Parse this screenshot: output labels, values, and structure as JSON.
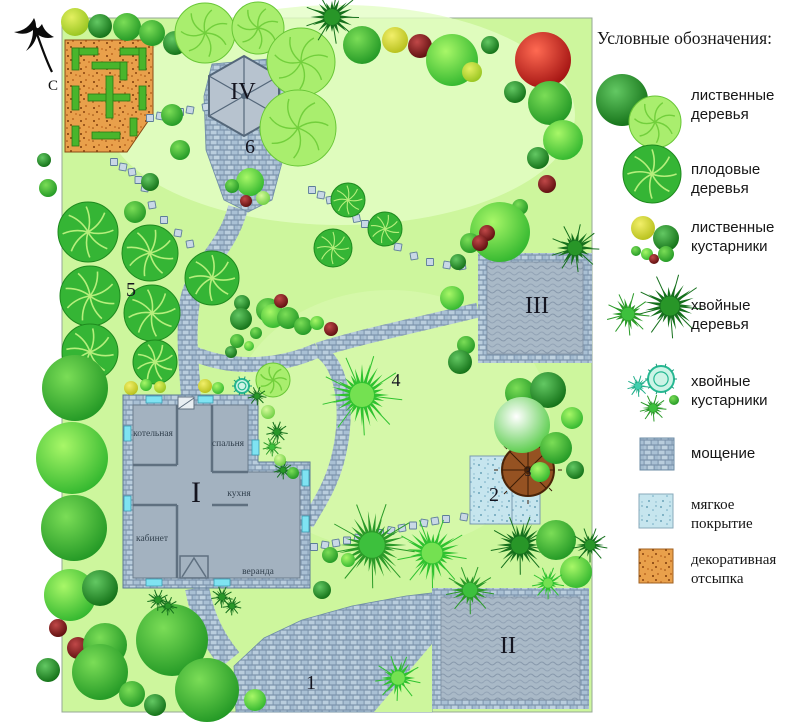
{
  "legend": {
    "title": "Условные обозначения:",
    "items": [
      {
        "id": "deciduous-trees",
        "label": "лиственные деревья"
      },
      {
        "id": "fruit-trees",
        "label": "плодовые деревья"
      },
      {
        "id": "deciduous-shrubs",
        "label": "лиственные кустарники"
      },
      {
        "id": "coniferous-trees",
        "label": "хвойные деревья"
      },
      {
        "id": "coniferous-shrubs",
        "label": "хвойные кустарники"
      },
      {
        "id": "paving",
        "label": "мощение"
      },
      {
        "id": "soft-covering",
        "label": "мягкое покрытие"
      },
      {
        "id": "decorative-mulch",
        "label": "декоративная отсыпка"
      }
    ]
  },
  "palette": {
    "lawn": "#cdf69d",
    "paving": "#aec3d6",
    "mulch_orange": "#e9a04b",
    "soft_blue": "#c6e5ee",
    "red_tree": "#cc1212",
    "dark_green": "#15701c"
  },
  "plan": {
    "compass_letter": "С",
    "labels": [
      {
        "text": "IV",
        "x": 243,
        "y": 99,
        "size": 24
      },
      {
        "text": "6",
        "x": 250,
        "y": 153,
        "size": 20
      },
      {
        "text": "5",
        "x": 131,
        "y": 296,
        "size": 20
      },
      {
        "text": "III",
        "x": 537,
        "y": 313,
        "size": 24
      },
      {
        "text": "4",
        "x": 396,
        "y": 386,
        "size": 18
      },
      {
        "text": "I",
        "x": 196,
        "y": 502,
        "size": 30
      },
      {
        "text": "2",
        "x": 494,
        "y": 501,
        "size": 20
      },
      {
        "text": "3",
        "x": 528,
        "y": 476,
        "size": 13
      },
      {
        "text": "II",
        "x": 508,
        "y": 653,
        "size": 24
      },
      {
        "text": "1",
        "x": 311,
        "y": 689,
        "size": 20
      }
    ],
    "rooms": [
      {
        "text": "котельная",
        "x": 153,
        "y": 436
      },
      {
        "text": "спальня",
        "x": 228,
        "y": 446
      },
      {
        "text": "кухня",
        "x": 239,
        "y": 496
      },
      {
        "text": "кабинет",
        "x": 152,
        "y": 541
      },
      {
        "text": "веранда",
        "x": 258,
        "y": 574
      }
    ]
  },
  "trees": [
    [
      75,
      22,
      14,
      "r",
      "yg"
    ],
    [
      100,
      26,
      12,
      "r",
      "dg"
    ],
    [
      127,
      27,
      14,
      "r",
      "mg"
    ],
    [
      152,
      33,
      13,
      "r",
      "mg"
    ],
    [
      175,
      43,
      12,
      "r",
      "dg"
    ],
    [
      205,
      33,
      30,
      "l"
    ],
    [
      258,
      28,
      26,
      "l"
    ],
    [
      301,
      62,
      34,
      "l"
    ],
    [
      298,
      128,
      38,
      "l"
    ],
    [
      332,
      17,
      20,
      "c",
      "cd"
    ],
    [
      362,
      45,
      19,
      "r",
      "mg"
    ],
    [
      395,
      40,
      13,
      "r",
      "yl"
    ],
    [
      420,
      46,
      12,
      "r",
      "dr"
    ],
    [
      452,
      60,
      26,
      "r",
      "bg"
    ],
    [
      472,
      72,
      10,
      "r",
      "yg"
    ],
    [
      490,
      45,
      9,
      "r",
      "dg"
    ],
    [
      543,
      60,
      28,
      "r",
      "rd"
    ],
    [
      515,
      92,
      11,
      "r",
      "dg"
    ],
    [
      550,
      103,
      22,
      "r",
      "mg"
    ],
    [
      563,
      140,
      20,
      "r",
      "bg"
    ],
    [
      538,
      158,
      11,
      "r",
      "dg"
    ],
    [
      547,
      184,
      9,
      "r",
      "dr"
    ],
    [
      520,
      207,
      8,
      "r",
      "mg"
    ],
    [
      500,
      232,
      30,
      "r",
      "bg"
    ],
    [
      575,
      248,
      18,
      "c",
      "cd"
    ],
    [
      470,
      243,
      10,
      "r",
      "mg"
    ],
    [
      487,
      233,
      8,
      "r",
      "dr"
    ],
    [
      480,
      243,
      8,
      "r",
      "dr"
    ],
    [
      458,
      262,
      8,
      "r",
      "dg"
    ],
    [
      452,
      298,
      12,
      "r",
      "bg"
    ],
    [
      466,
      345,
      9,
      "r",
      "mg"
    ],
    [
      460,
      362,
      12,
      "r",
      "dg"
    ],
    [
      172,
      115,
      11,
      "r",
      "mg"
    ],
    [
      180,
      150,
      10,
      "r",
      "mg"
    ],
    [
      150,
      182,
      9,
      "r",
      "dg"
    ],
    [
      135,
      212,
      11,
      "r",
      "mg"
    ],
    [
      250,
      182,
      14,
      "r",
      "bg"
    ],
    [
      232,
      186,
      7,
      "r",
      "mg"
    ],
    [
      246,
      201,
      6,
      "r",
      "dr"
    ],
    [
      263,
      198,
      7,
      "r",
      "lg"
    ],
    [
      88,
      232,
      30,
      "f"
    ],
    [
      150,
      253,
      28,
      "f"
    ],
    [
      212,
      278,
      27,
      "f"
    ],
    [
      90,
      296,
      30,
      "f"
    ],
    [
      152,
      313,
      28,
      "f"
    ],
    [
      90,
      352,
      28,
      "f"
    ],
    [
      155,
      362,
      22,
      "f"
    ],
    [
      348,
      200,
      17,
      "f"
    ],
    [
      385,
      229,
      17,
      "f"
    ],
    [
      333,
      248,
      19,
      "f"
    ],
    [
      242,
      303,
      8,
      "r",
      "dg"
    ],
    [
      268,
      310,
      12,
      "r",
      "mg"
    ],
    [
      241,
      319,
      11,
      "r",
      "dg"
    ],
    [
      273,
      316,
      12,
      "r",
      "bg"
    ],
    [
      288,
      318,
      11,
      "r",
      "mg"
    ],
    [
      303,
      326,
      9,
      "r",
      "mg"
    ],
    [
      317,
      323,
      7,
      "r",
      "bg"
    ],
    [
      281,
      301,
      7,
      "r",
      "dr"
    ],
    [
      331,
      329,
      7,
      "r",
      "dr"
    ],
    [
      256,
      333,
      6,
      "r",
      "mg"
    ],
    [
      237,
      341,
      7,
      "r",
      "mg"
    ],
    [
      249,
      346,
      5,
      "r",
      "bg"
    ],
    [
      231,
      352,
      6,
      "r",
      "dg"
    ],
    [
      362,
      395,
      30,
      "c",
      "cb"
    ],
    [
      131,
      388,
      7,
      "r",
      "yl"
    ],
    [
      146,
      385,
      6,
      "r",
      "bg"
    ],
    [
      160,
      387,
      6,
      "r",
      "yg"
    ],
    [
      205,
      386,
      7,
      "r",
      "yl"
    ],
    [
      218,
      388,
      6,
      "r",
      "bg"
    ],
    [
      242,
      386,
      7,
      "ring"
    ],
    [
      273,
      380,
      17,
      "l"
    ],
    [
      257,
      396,
      7,
      "c",
      "cd"
    ],
    [
      268,
      412,
      7,
      "r",
      "lg"
    ],
    [
      277,
      432,
      8,
      "c",
      "cd"
    ],
    [
      272,
      447,
      7,
      "c",
      "cm"
    ],
    [
      283,
      470,
      7,
      "c",
      "cd"
    ],
    [
      280,
      460,
      6,
      "r",
      "lg"
    ],
    [
      293,
      473,
      6,
      "r",
      "mg"
    ],
    [
      520,
      393,
      15,
      "r",
      "mg"
    ],
    [
      548,
      390,
      18,
      "r",
      "dg"
    ],
    [
      522,
      425,
      28,
      "r",
      "wh"
    ],
    [
      556,
      448,
      16,
      "r",
      "mg"
    ],
    [
      572,
      418,
      11,
      "r",
      "bg"
    ],
    [
      540,
      472,
      10,
      "r",
      "bg"
    ],
    [
      575,
      470,
      9,
      "r",
      "dg"
    ],
    [
      372,
      545,
      32,
      "c",
      "cm"
    ],
    [
      432,
      553,
      26,
      "c",
      "cb"
    ],
    [
      470,
      590,
      18,
      "c",
      "cm"
    ],
    [
      520,
      545,
      22,
      "c",
      "cd"
    ],
    [
      556,
      540,
      20,
      "r",
      "mg"
    ],
    [
      576,
      572,
      16,
      "r",
      "bg"
    ],
    [
      548,
      583,
      12,
      "c",
      "cb"
    ],
    [
      590,
      545,
      13,
      "c",
      "cd"
    ],
    [
      330,
      555,
      8,
      "r",
      "mg"
    ],
    [
      348,
      560,
      7,
      "r",
      "bg"
    ],
    [
      322,
      590,
      9,
      "r",
      "dg"
    ],
    [
      75,
      388,
      33,
      "r",
      "mg"
    ],
    [
      72,
      458,
      36,
      "r",
      "bg"
    ],
    [
      74,
      528,
      33,
      "r",
      "mg"
    ],
    [
      70,
      595,
      26,
      "r",
      "bg"
    ],
    [
      58,
      628,
      9,
      "r",
      "dr"
    ],
    [
      78,
      648,
      11,
      "r",
      "dr"
    ],
    [
      105,
      645,
      22,
      "r",
      "mg"
    ],
    [
      48,
      670,
      12,
      "r",
      "dg"
    ],
    [
      100,
      588,
      18,
      "r",
      "dg"
    ],
    [
      172,
      640,
      36,
      "r",
      "mg"
    ],
    [
      207,
      690,
      32,
      "r",
      "mg"
    ],
    [
      100,
      672,
      28,
      "r",
      "mg"
    ],
    [
      132,
      694,
      13,
      "r",
      "mg"
    ],
    [
      155,
      705,
      11,
      "r",
      "dg"
    ],
    [
      158,
      600,
      8,
      "c",
      "cd"
    ],
    [
      168,
      606,
      7,
      "c",
      "cd"
    ],
    [
      222,
      597,
      8,
      "c",
      "cd"
    ],
    [
      232,
      606,
      7,
      "c",
      "cd"
    ],
    [
      398,
      678,
      17,
      "c",
      "cb"
    ],
    [
      255,
      700,
      11,
      "r",
      "bg"
    ],
    [
      48,
      188,
      9,
      "r",
      "mg"
    ],
    [
      44,
      160,
      7,
      "r",
      "dg"
    ]
  ],
  "legend_glyphs": [
    [
      622,
      100,
      26,
      "r",
      "dg"
    ],
    [
      655,
      122,
      26,
      "l"
    ],
    [
      652,
      174,
      29,
      "f"
    ],
    [
      643,
      228,
      12,
      "r",
      "yl"
    ],
    [
      666,
      238,
      13,
      "r",
      "dg"
    ],
    [
      636,
      251,
      5,
      "r",
      "mg"
    ],
    [
      647,
      254,
      6,
      "r",
      "bg"
    ],
    [
      654,
      259,
      5,
      "r",
      "dr"
    ],
    [
      666,
      254,
      8,
      "r",
      "mg"
    ],
    [
      628,
      314,
      16,
      "c",
      "cm"
    ],
    [
      670,
      306,
      24,
      "c",
      "cd"
    ],
    [
      661,
      379,
      13,
      "ring"
    ],
    [
      638,
      386,
      8,
      "c",
      "ct"
    ],
    [
      653,
      408,
      10,
      "c",
      "cm"
    ],
    [
      674,
      400,
      5,
      "r",
      "mg"
    ]
  ],
  "stepping_paths": [
    [
      [
        150,
        118
      ],
      [
        170,
        114
      ],
      [
        190,
        110
      ],
      [
        206,
        107
      ]
    ],
    [
      [
        114,
        162
      ],
      [
        132,
        172
      ],
      [
        145,
        188
      ],
      [
        152,
        205
      ],
      [
        164,
        220
      ],
      [
        178,
        233
      ],
      [
        190,
        244
      ]
    ],
    [
      [
        312,
        190
      ],
      [
        330,
        200
      ],
      [
        348,
        213
      ],
      [
        365,
        224
      ],
      [
        382,
        235
      ],
      [
        398,
        247
      ],
      [
        414,
        256
      ],
      [
        430,
        262
      ],
      [
        447,
        265
      ],
      [
        462,
        266
      ]
    ],
    [
      [
        314,
        547
      ],
      [
        336,
        543
      ],
      [
        358,
        538
      ],
      [
        380,
        533
      ],
      [
        402,
        528
      ],
      [
        424,
        523
      ],
      [
        446,
        519
      ],
      [
        464,
        517
      ]
    ]
  ]
}
